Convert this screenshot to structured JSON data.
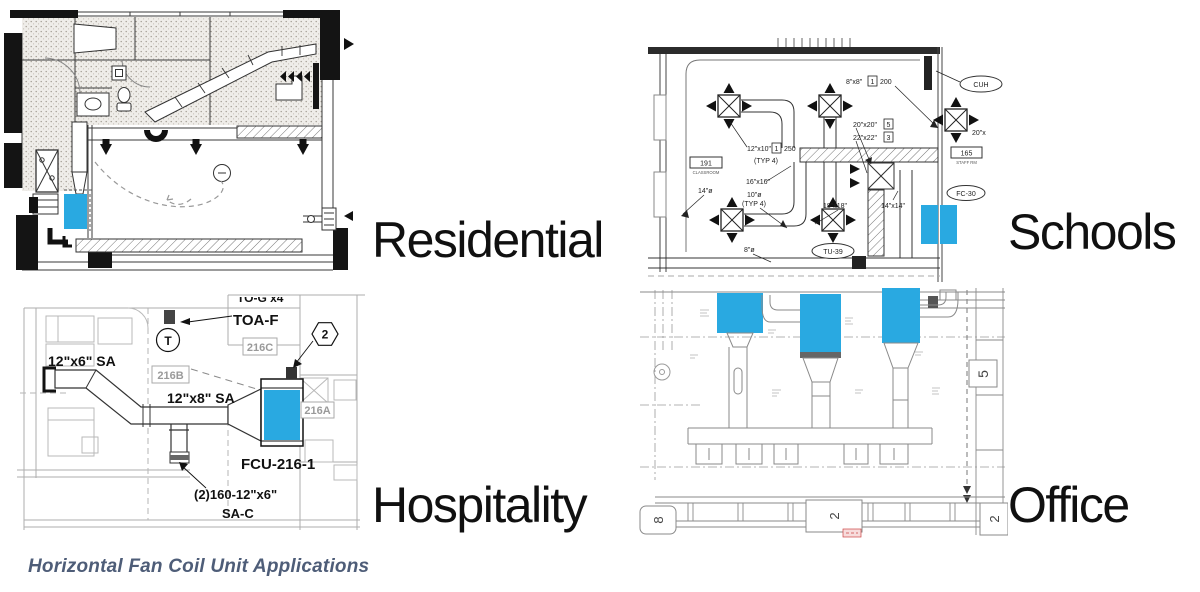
{
  "caption": {
    "text": "Horizontal Fan Coil Unit Applications"
  },
  "colors": {
    "highlight": "#29a9e1",
    "caption_text": "#4e5d78",
    "ink": "#111111",
    "cad_grey": "#8a8a8a"
  },
  "panels": {
    "residential": {
      "label": "Residential"
    },
    "schools": {
      "label": "Schools",
      "room_tag": "191",
      "room_name": "CLASSROOM",
      "staff_tag": "165",
      "staff_name": "STAFF RM",
      "tu_tag": "TU-39",
      "fc_tag": "FC-30",
      "cuh_tag": "CUH",
      "duct_12x10": "12\"x10\"",
      "box_1a": "1",
      "cfm_250": "250",
      "typ4_a": "(TYP 4)",
      "duct_16x16": "16\"x16\"",
      "duct_10dia": "10\"ø",
      "typ4_b": "(TYP 4)",
      "duct_14dia": "14\"ø",
      "duct_18x18": "18\"x18\"",
      "duct_14x14": "14\"x14\"",
      "duct_8dia": "8\"ø",
      "duct_20x20": "20\"x20\"",
      "box_5": "5",
      "duct_22x22": "22\"x22\"",
      "box_3": "3",
      "duct_8x8": "8\"x8\"",
      "box_1b": "1",
      "cfm_200": "200",
      "duct_20_clipped": "20\"x"
    },
    "hospitality": {
      "label": "Hospitality",
      "duct_12x6": "12\"x6\" SA",
      "duct_12x8": "12\"x8\" SA",
      "toaf": "TOA-F",
      "clipped_top": "TO-G x4",
      "thermostat": "T",
      "keynote": "2",
      "room_216c": "216C",
      "room_216b": "216B",
      "room_216a": "216A",
      "unit_tag": "FCU-216-1",
      "grille_note": "(2)160-12\"x6\"",
      "grille_note2": "SA-C"
    },
    "office": {
      "label": "Office",
      "grid_5": "5",
      "grid_8": "8",
      "grid_2": "2",
      "grid_2b": "2"
    }
  }
}
